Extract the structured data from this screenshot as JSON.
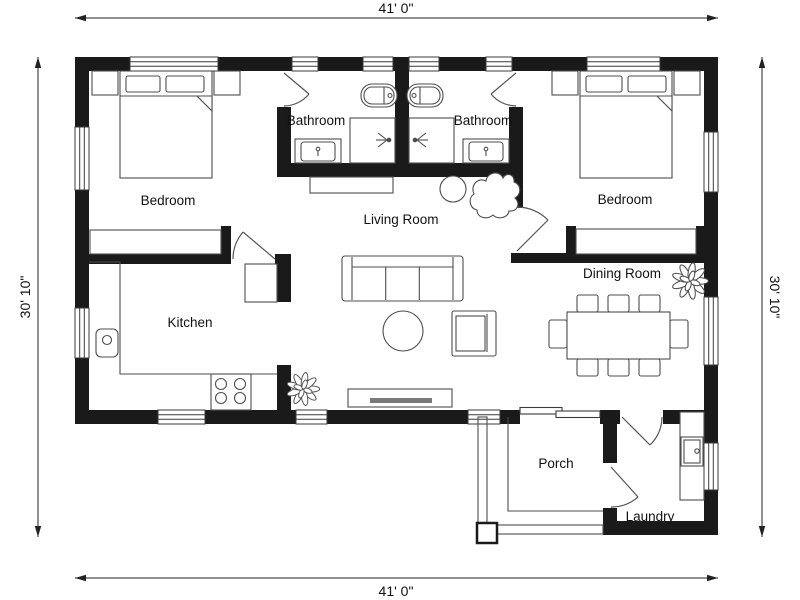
{
  "plan": {
    "dimension_labels": {
      "top": "41' 0\"",
      "bottom": "41' 0\"",
      "left": "30' 10\"",
      "right": "30' 10\""
    },
    "rooms": {
      "bedroom_left": "Bedroom",
      "bathroom_left": "Bathroom",
      "bathroom_right": "Bathroom",
      "bedroom_right": "Bedroom",
      "living_room": "Living Room",
      "kitchen": "Kitchen",
      "dining_room": "Dining Room",
      "porch": "Porch",
      "laundry": "Laundry"
    },
    "colors": {
      "wall": "#1a1a1a",
      "furniture_line": "#4d4d4d",
      "door_line": "#555555",
      "background": "#ffffff",
      "text": "#111111"
    }
  }
}
